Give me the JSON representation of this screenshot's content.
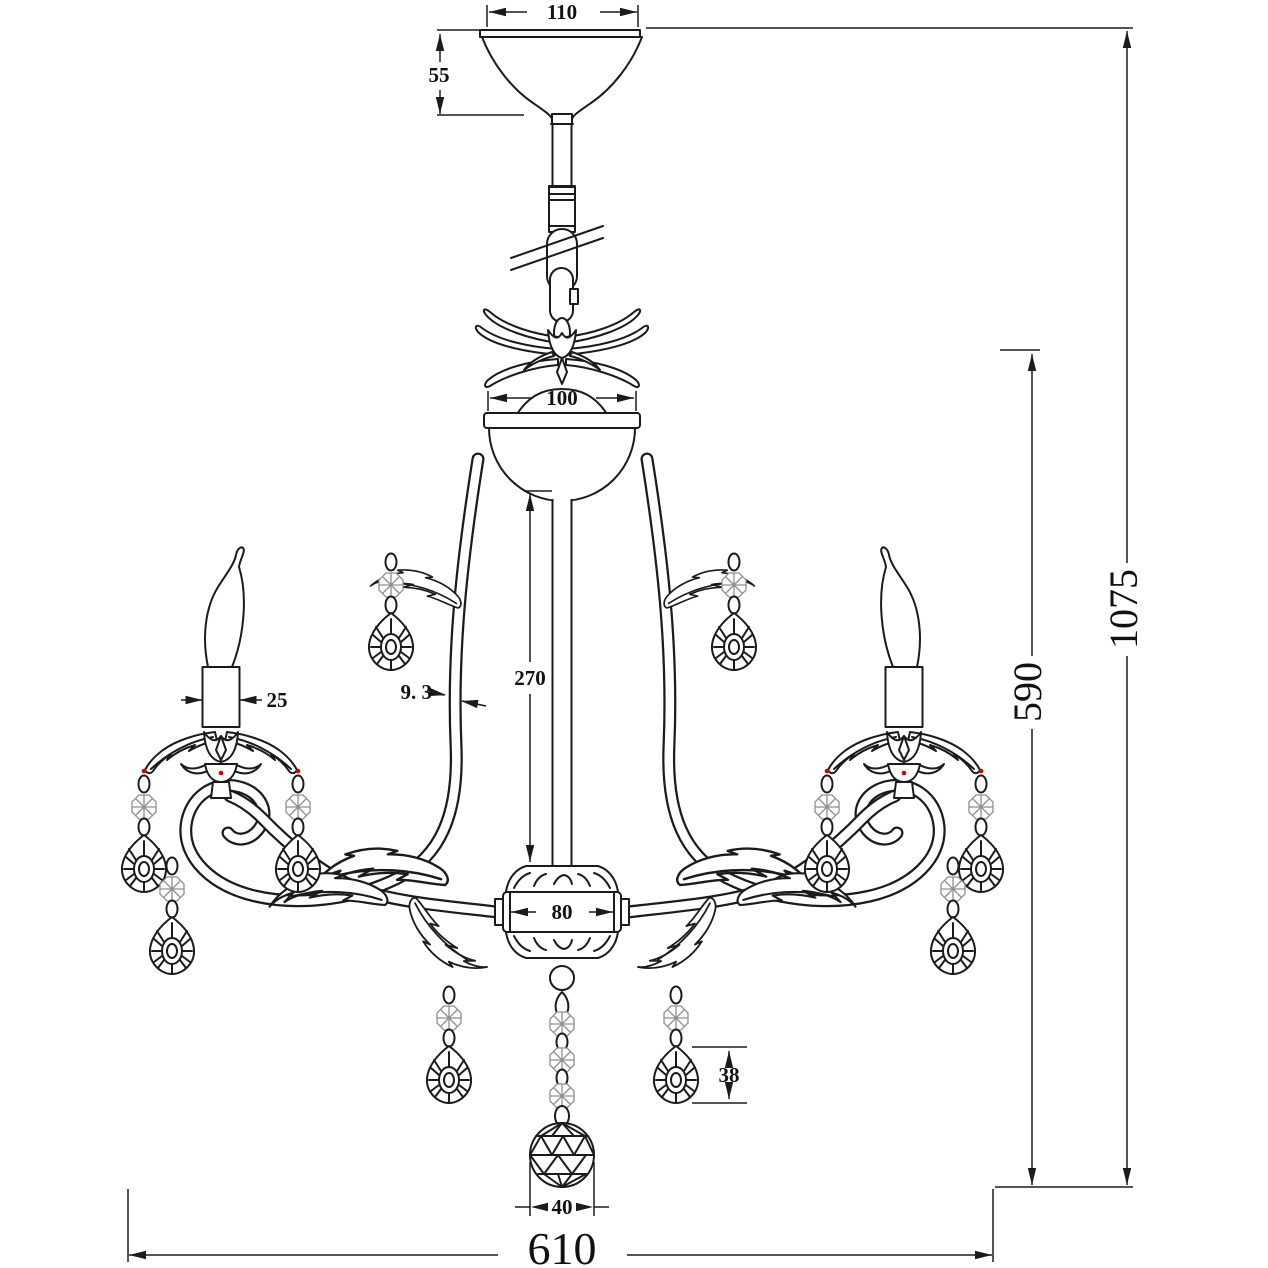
{
  "drawing": {
    "background": "#ffffff",
    "line_color": "#1b1b1b",
    "accent_dot_color": "#cc0000",
    "subject": "chandelier dimension drawing",
    "dimensions": {
      "canopy_width": "110",
      "canopy_height": "55",
      "body_cap_width": "100",
      "center_column_length": "270",
      "arm_tube_diameter": "9. 3",
      "candle_sleeve_diameter": "25",
      "hub_width": "80",
      "drop_pendant_height": "38",
      "bottom_ball_diameter": "40",
      "body_height": "590",
      "overall_height": "1075",
      "overall_width": "610"
    }
  }
}
